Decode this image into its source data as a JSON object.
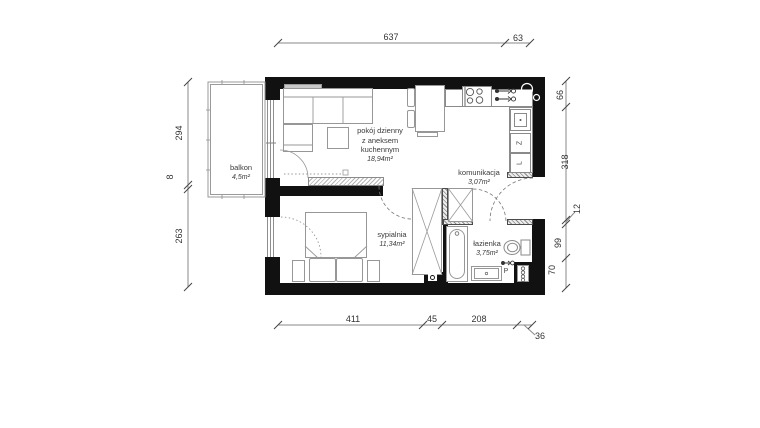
{
  "rooms": {
    "living": {
      "line1": "pokój dzienny",
      "line2": "z aneksem",
      "line3": "kuchennym",
      "area": "18,94m²"
    },
    "hall": {
      "name": "komunikacja",
      "area": "3,07m²"
    },
    "bedroom": {
      "name": "sypialnia",
      "area": "11,34m²"
    },
    "bathroom": {
      "name": "łazienka",
      "area": "3,75m²"
    },
    "balcony": {
      "name": "balkon",
      "area": "4,5m²"
    }
  },
  "appliances": {
    "dishwasher_label": "Z",
    "fridge_label": "L",
    "washer_label": "P"
  },
  "dimensions": {
    "top": {
      "a": "637",
      "b": "63"
    },
    "bottom": {
      "a": "411",
      "b": "45",
      "c": "208",
      "d": "36"
    },
    "left": {
      "a": "294",
      "b": "8",
      "c": "263"
    },
    "right": {
      "a": "66",
      "b": "318",
      "c": "12",
      "d": "99",
      "e": "70"
    }
  },
  "colors": {
    "wall": "#111111",
    "furniture_line": "#979797",
    "dimension_line": "#8a8a8a",
    "text": "#3a3a3a"
  }
}
